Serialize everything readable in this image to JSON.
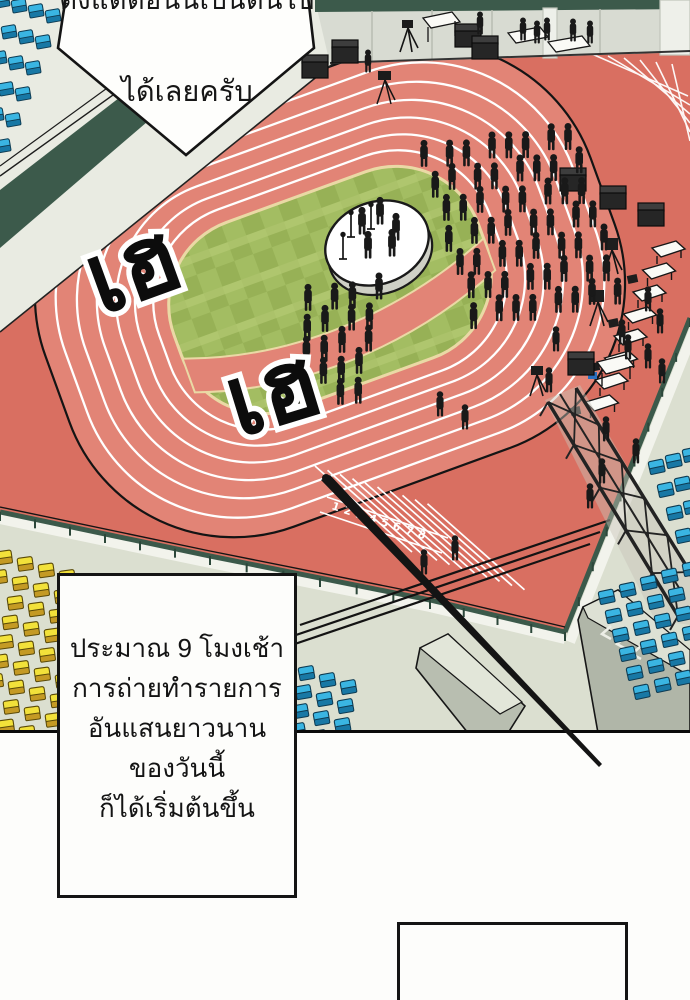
{
  "bubble": {
    "line1": "ตั้งแต่ตอนนี้เป็นต้นไป",
    "line2": "ได้เลยครับ"
  },
  "sfx": [
    {
      "text": "เฮ"
    },
    {
      "text": "เฮ"
    }
  ],
  "caption": {
    "lines": [
      "ประมาณ 9 โมงเช้า",
      "การถ่ายทำรายการ",
      "อันแสนยาวนาน",
      "ของวันนี้",
      "ก็ได้เริ่มต้นขึ้น"
    ]
  },
  "lane_numbers": [
    "1",
    "2",
    "3",
    "4",
    "5",
    "6",
    "7",
    "8"
  ],
  "palette": {
    "apron_red": "#d96f61",
    "track_red": "#e28476",
    "lane_line": "#ffffff",
    "field_green_light": "#a3bd62",
    "field_green_dark": "#97b156",
    "field_stripe": "#b6cb75",
    "field_edge_cream": "#ead9a5",
    "rail_green": "#3b594a",
    "wall_gray": "#d8dbd2",
    "concrete": "#dbdfd0",
    "seat_yellow": "#f2e13a",
    "seat_blue": "#3ab5e2",
    "silhouette": "#191919",
    "stage_white": "#ffffff"
  }
}
